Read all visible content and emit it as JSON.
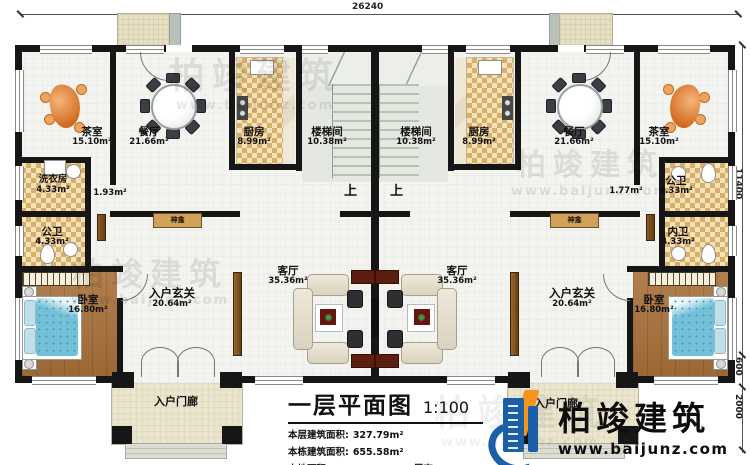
{
  "meta": {
    "sheet_title": "一层平面图",
    "scale": "1:100"
  },
  "dimensions": {
    "top": "26240",
    "right_main": "11400",
    "right_upper": "600",
    "right_lower": "2000"
  },
  "stats": [
    {
      "label": "本层建筑面积:",
      "value": "327.79m²"
    },
    {
      "label": "本栋建筑面积:",
      "value": "655.58m²"
    },
    {
      "label": "占地面积:",
      "value": "341.02m²"
    },
    {
      "label": "层高:",
      "value": "3.9m"
    }
  ],
  "logo": {
    "brand": "柏竣建筑",
    "website": "www.baijunz.com"
  },
  "watermark": {
    "text": "柏竣建筑",
    "url": "www.baijunz.com"
  },
  "rooms_left": {
    "tea": {
      "name": "茶室",
      "area": "15.10m²"
    },
    "dining": {
      "name": "餐厅",
      "area": "21.66m²"
    },
    "kitchen": {
      "name": "厨房",
      "area": "8.99m²"
    },
    "stair": {
      "name": "楼梯间",
      "area": "10.38m²"
    },
    "laundry": {
      "name": "洗衣房",
      "area": "4.33m²"
    },
    "pass_area": "1.93m²",
    "bath": {
      "name": "公卫",
      "area": "4.33m²"
    },
    "bedroom": {
      "name": "卧室",
      "area": "16.80m²"
    },
    "foyer": {
      "name": "入户玄关",
      "area": "20.64m²"
    },
    "living": {
      "name": "客厅",
      "area": "35.36m²"
    },
    "shrine": "神龛",
    "up": "上",
    "porch": "入户门廊"
  },
  "rooms_right": {
    "stair": {
      "name": "楼梯间",
      "area": "10.38m²"
    },
    "kitchen": {
      "name": "厨房",
      "area": "8.99m²"
    },
    "dining": {
      "name": "餐厅",
      "area": "21.66m²"
    },
    "tea": {
      "name": "茶室",
      "area": "15.10m²"
    },
    "pass_area": "1.77m²",
    "bath_public": {
      "name": "公卫",
      "area": "4.33m²"
    },
    "bath_private": {
      "name": "内卫",
      "area": "4.33m²"
    },
    "bedroom": {
      "name": "卧室",
      "area": "16.80m²"
    },
    "foyer": {
      "name": "入户玄关",
      "area": "20.64m²"
    },
    "living": {
      "name": "客厅",
      "area": "35.36m²"
    },
    "shrine": "神龛",
    "up": "上",
    "porch": "入户门廊"
  }
}
